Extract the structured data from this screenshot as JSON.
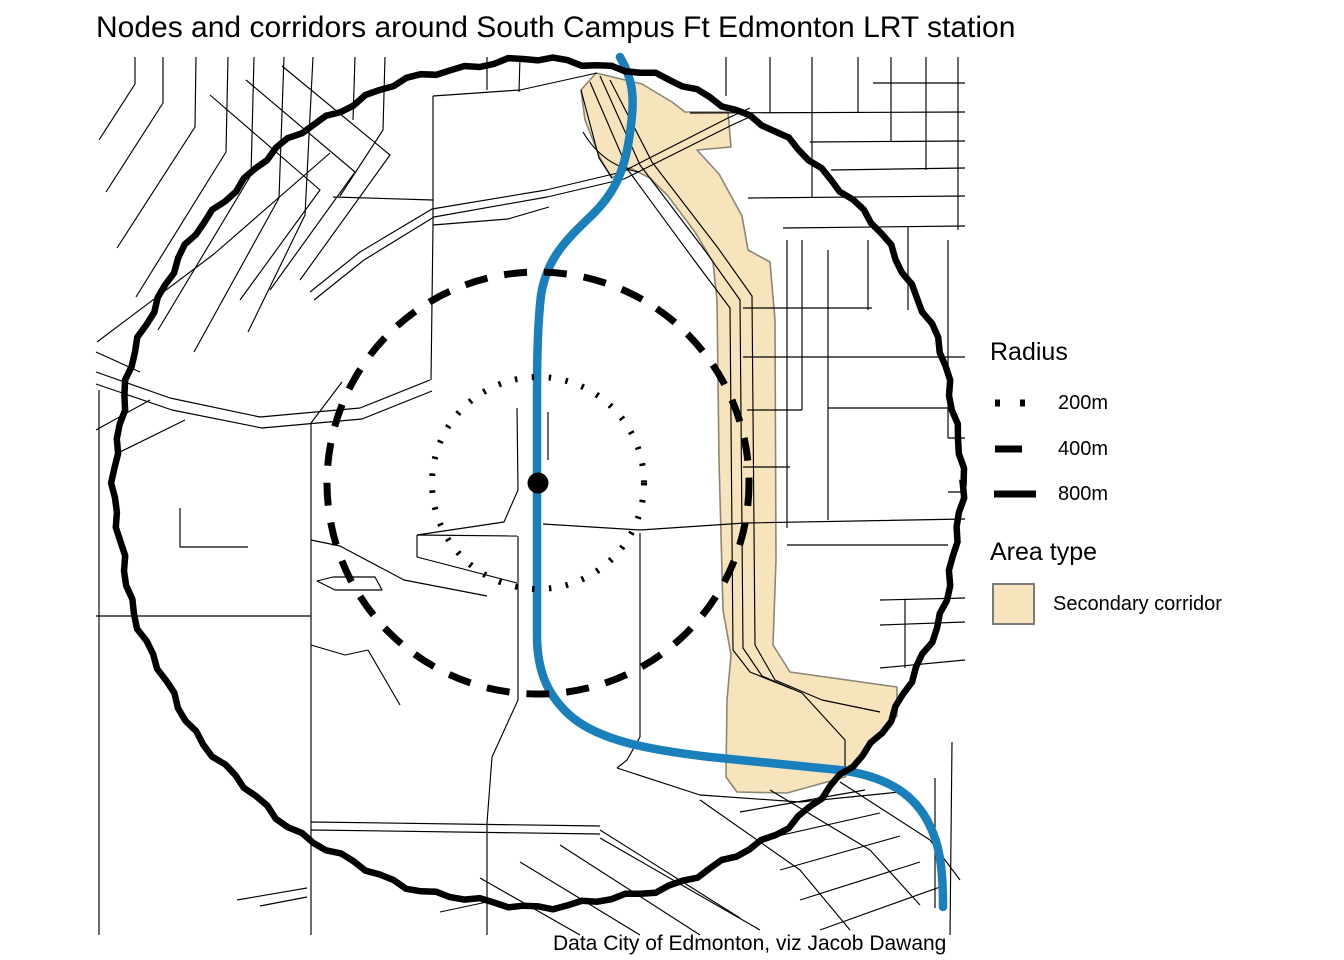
{
  "figure": {
    "title": "Nodes and corridors around South Campus Ft Edmonton LRT station",
    "caption": "Data City of Edmonton, viz Jacob Dawang"
  },
  "legend": {
    "radius": {
      "title": "Radius",
      "items": [
        {
          "label": "200m",
          "style": "dotted"
        },
        {
          "label": "400m",
          "style": "dashed"
        },
        {
          "label": "800m",
          "style": "solid"
        }
      ]
    },
    "area_type": {
      "title": "Area type",
      "items": [
        {
          "label": "Secondary corridor",
          "style": "swatch"
        }
      ]
    }
  },
  "map": {
    "station": {
      "x": 538,
      "y": 483,
      "dot_radius": 10.5
    },
    "rings": [
      {
        "radius_label": "200m",
        "radius_px": 106,
        "style": "dotted",
        "stroke_width": 6,
        "dasharray": "2.5 14.5"
      },
      {
        "radius_label": "400m",
        "radius_px": 211,
        "style": "dashed",
        "stroke_width": 7,
        "dasharray": "23 17"
      },
      {
        "radius_label": "800m",
        "radius_px": 423,
        "style": "solid",
        "stroke_width": 6.5,
        "dasharray": ""
      }
    ],
    "colors": {
      "street": "#000000",
      "lrt": "#1A80BC",
      "corridor_fill": "#F7E4BC",
      "corridor_border": "#8C8674",
      "ring": "#000000"
    },
    "corridor_path": "M596,73 L642,84 L672,102 L685,112 L728,112 L731,147 L697,150 L719,174 L742,216 L748,250 L770,262 L775,320 L776,560 L773,645 L790,672 L897,687 L897,716 L845,777 L787,793 L737,792 L726,777 L727,700 L731,655 L723,610 L719,460 L717,300 L713,262 L695,232 L668,196 L650,178 L630,168 L612,178 L600,158 L585,120 L581,90 Z",
    "lrt_path": "M620,57 C632,78 635,95 631,125 C626,170 615,193 591,216 C566,240 547,258 541,295 C538,322 537,350 537,400 L537,635 C537,672 548,697 573,718 C602,741 650,750 710,757 L840,770 C890,777 916,796 930,826 C940,846 943,870 943,907",
    "streets": [
      "M135,57 L135,84 L99,140",
      "M163,57 L163,103 L106,192",
      "M196,57 L195,127 L117,248",
      "M228,57 L226,152 L136,297",
      "M254,57 L251,175 L158,330",
      "M284,57 L279,198 L194,352",
      "M313,57 L305,215 L248,332",
      "M97,342 L214,254 L330,153",
      "M210,95 L320,190 L240,300",
      "M246,80 L355,172 L270,290",
      "M282,66 L390,155 L300,280",
      "M433,96 L520,90 L597,73",
      "M433,96 L433,225",
      "M333,197 L433,200",
      "M433,225 L508,219 L549,207",
      "M385,57 L383,130 L340,196",
      "M355,57 L353,120",
      "M487,57 L487,90",
      "M520,57 L519,92",
      "M433,225 L431,380",
      "M310,292 L360,252 L432,209 L546,190 L622,172 L728,118 L750,108",
      "M314,300 L364,260 L434,217 L547,197 L624,179 L732,125 L754,115",
      "M600,76 L640,165 L706,252 L740,300 L743,648 L762,676 L802,693",
      "M590,82 L628,170 L694,260 L730,308 L733,650 L750,672 L792,689",
      "M610,80 L652,162 L718,248 L752,296 L755,645 L775,680 L822,700",
      "M583,132 Q603,166 639,172",
      "M581,90 L599,158 L612,178",
      "M802,693 L845,740 L845,775",
      "M822,700 L880,712",
      "M726,57 L726,96",
      "M770,57 L770,113",
      "M812,57 L812,198",
      "M858,57 L858,113",
      "M891,57 L891,142",
      "M926,57 L926,170",
      "M958,57 L958,230",
      "M873,83 L965,83",
      "M690,113 L965,112",
      "M810,142 L965,141",
      "M831,170 L965,168",
      "M748,198 L965,196",
      "M783,228 L965,226",
      "M787,240 L787,528",
      "M802,240 L802,410",
      "M828,250 L828,520",
      "M868,240 L868,310",
      "M908,226 L908,310",
      "M948,240 L948,438",
      "M743,308 L872,308",
      "M743,357 L965,357",
      "M747,410 L802,410",
      "M828,408 L948,408",
      "M948,438 L965,438",
      "M743,467 L790,467",
      "M948,492 L965,492",
      "M543,524 L640,530 L745,523 L965,519",
      "M787,545 L948,545",
      "M880,600 L965,598",
      "M905,600 L905,668",
      "M880,625 L965,622",
      "M880,668 L965,660",
      "M96,372 L170,398 L260,417 L360,408 L430,380",
      "M96,384 L172,410 L262,428 L362,419 L432,391",
      "M96,430 L150,400",
      "M120,452 L185,420",
      "M96,352 L140,372",
      "M99,390 L99,935",
      "M96,616 L311,616",
      "M311,423 L311,935",
      "M311,423 L342,382",
      "M180,508 L180,547 L248,547",
      "M311,540 L340,546 L404,580 L487,596",
      "M417,535 L517,536",
      "M417,535 L417,557 L517,583",
      "M317,581 L333,577 L375,577 L382,590 L335,590 Z",
      "M517,408 L518,490 L504,522 L417,535",
      "M548,412 L548,460",
      "M518,536 L518,700 L492,757 L487,823 L487,935",
      "M640,533 L640,737 L627,760 L617,768",
      "M311,645 L345,655 L368,650",
      "M368,650 L400,705",
      "M237,900 L307,888",
      "M260,906 L307,897",
      "M440,912 L487,902",
      "M311,822 L600,826",
      "M311,830 L600,834",
      "M600,830 L740,918",
      "M560,845 L700,935",
      "M520,862 L640,935",
      "M480,878 L580,935",
      "M600,838 L760,930",
      "M617,768 L700,795 L800,802 L900,792",
      "M740,812 L865,790",
      "M760,840 L880,813",
      "M780,870 L900,836",
      "M800,900 L920,862",
      "M820,930 L940,887",
      "M700,800 L800,870 L850,930",
      "M770,790 L870,850 L920,905",
      "M840,782 L930,840 L960,880",
      "M935,778 L935,908",
      "M952,742 L950,935"
    ]
  }
}
